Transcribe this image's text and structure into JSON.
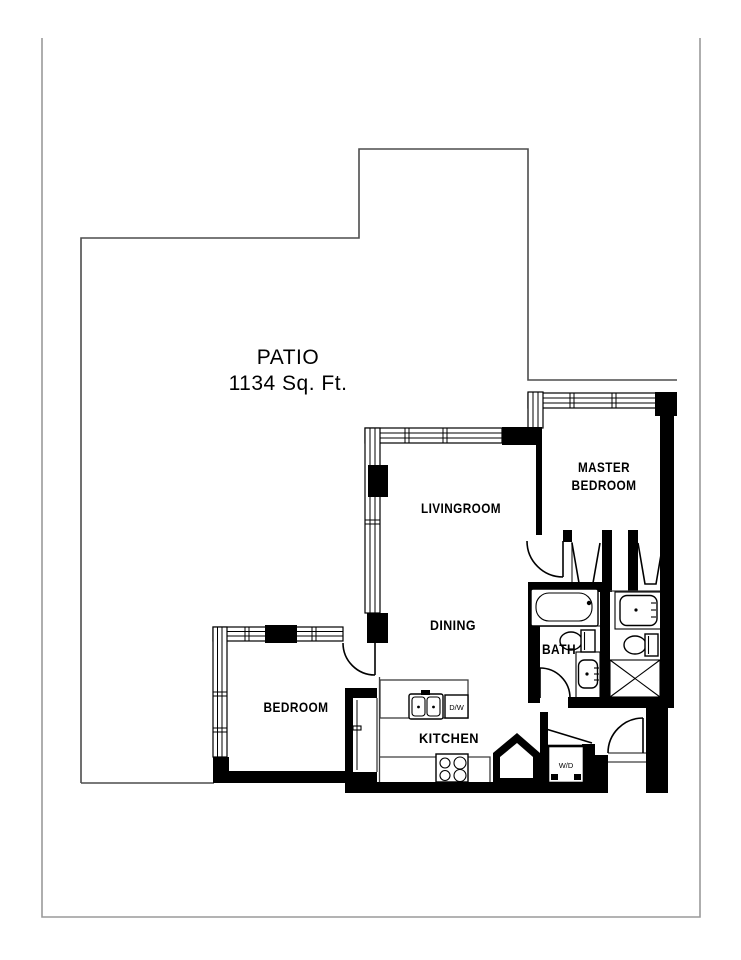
{
  "page": {
    "type": "residential floor plan"
  },
  "patio": {
    "title": "PATIO",
    "area": "1134 Sq. Ft."
  },
  "rooms": {
    "livingroom": "LIVINGROOM",
    "master_line1": "MASTER",
    "master_line2": "BEDROOM",
    "dining": "DINING",
    "bath": "BATH",
    "bedroom": "BEDROOM",
    "kitchen": "KITCHEN"
  },
  "appliances": {
    "dishwasher": "D/W",
    "washer_dryer": "W/D"
  },
  "colors": {
    "walls": "#000000",
    "thin_lines": "#3d3d3d",
    "patio_outline": "#4d4d4d",
    "page_border": "#9a9a9a",
    "background": "#ffffff"
  }
}
